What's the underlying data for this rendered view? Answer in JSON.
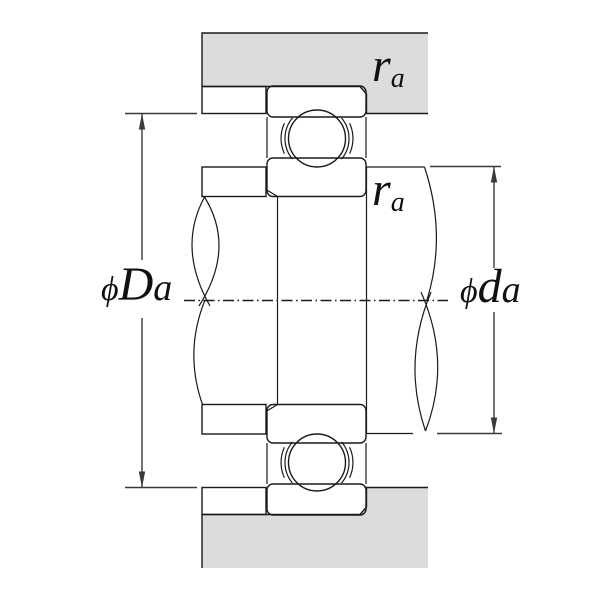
{
  "diagram": {
    "type": "bearing-mounting-dimensions-cross-section",
    "colors": {
      "background": "#ffffff",
      "housing_fill": "#dcdcdc",
      "abutment_fill": "#9fb0b8",
      "part_fill": "#ffffff",
      "outline": "#1a1a1a",
      "dimension": "#3a3a3a"
    },
    "labels": {
      "fillet_radius_housing": {
        "symbol": "r",
        "subscript": "a"
      },
      "fillet_radius_shaft": {
        "symbol": "r",
        "subscript": "a"
      },
      "housing_shoulder_diameter": {
        "prefix": "ϕ",
        "symbol": "D",
        "suffix": "a"
      },
      "shaft_shoulder_diameter": {
        "prefix": "ϕ",
        "symbol": "d",
        "suffix": "a"
      }
    }
  }
}
